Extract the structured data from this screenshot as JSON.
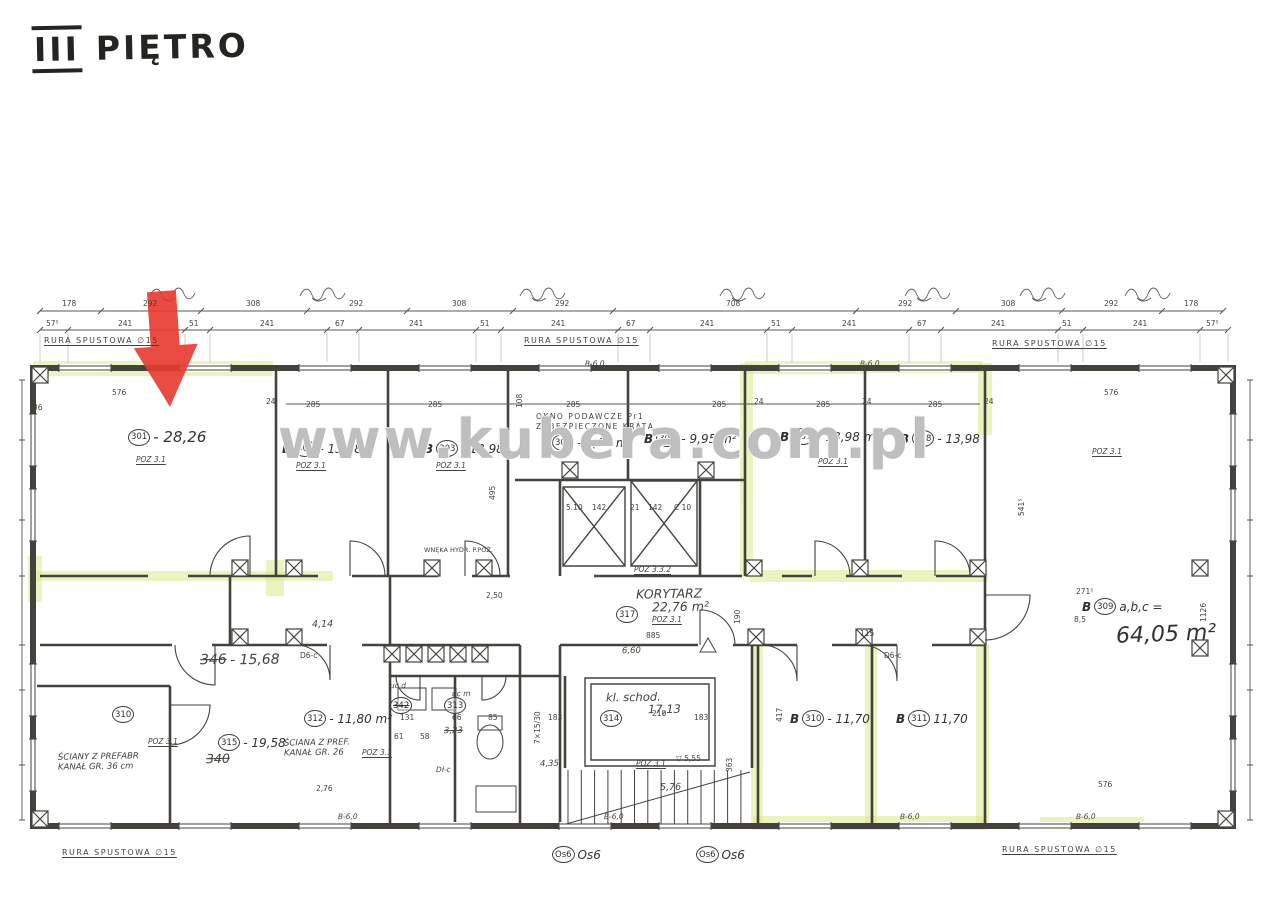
{
  "page": {
    "title_roman": "III",
    "title_text": "PIĘTRO"
  },
  "watermark": {
    "text": "www.kubera.com.pl",
    "color": "#8a8a8a"
  },
  "marker": {
    "description": "red arrow pointing at top wall of room 301",
    "color": "#e8392f"
  },
  "highlight_color": "#d7e783",
  "dims": {
    "row1": [
      "178",
      "292",
      "308",
      "292",
      "308",
      "292",
      "708",
      "292",
      "308",
      "292",
      "178"
    ],
    "row2": [
      "57⁵",
      "241",
      "51",
      "241",
      "67",
      "241",
      "51",
      "241",
      "67",
      "241",
      "51",
      "241",
      "67",
      "241",
      "51",
      "241",
      "57⁵"
    ]
  },
  "rooms": [
    {
      "pre": "",
      "num": "301",
      "post": "- 28,26",
      "x": 128,
      "y": 428,
      "big": true
    },
    {
      "pre": "B",
      "num": "302",
      "post": "- 13,98",
      "x": 282,
      "y": 440
    },
    {
      "pre": "B",
      "num": "303",
      "post": "- 13,98",
      "x": 424,
      "y": 440
    },
    {
      "pre": "",
      "num": "304",
      "post": "- 9,60 m²",
      "x": 552,
      "y": 434
    },
    {
      "pre": "B",
      "num": "306",
      "post": "- 9,95 m²",
      "x": 644,
      "y": 430
    },
    {
      "pre": "B",
      "num": "307",
      "post": "- 13,98 m²",
      "x": 780,
      "y": 428
    },
    {
      "pre": "B",
      "num": "308",
      "post": "- 13,98",
      "x": 900,
      "y": 430
    },
    {
      "pre": "B",
      "num": "309",
      "post": "a,b,c =",
      "x": 1082,
      "y": 598
    },
    {
      "pre": "",
      "num": "317",
      "post": "",
      "x": 616,
      "y": 606
    },
    {
      "pre": "",
      "num": "314",
      "post": "",
      "x": 600,
      "y": 710
    },
    {
      "pre": "",
      "num": "310",
      "post": "",
      "x": 112,
      "y": 706
    },
    {
      "pre": "",
      "num": "315",
      "post": "- 19,58",
      "x": 218,
      "y": 734
    },
    {
      "pre": "",
      "num": "313",
      "post": "",
      "x": 444,
      "y": 697
    },
    {
      "pre": "",
      "num": "342",
      "post": "",
      "x": 390,
      "y": 697,
      "struck": true
    },
    {
      "pre": "",
      "num": "312",
      "post": "- 11,80 m²",
      "x": 304,
      "y": 710
    },
    {
      "pre": "B",
      "num": "310",
      "post": "- 11,70",
      "x": 790,
      "y": 710
    },
    {
      "pre": "B",
      "num": "311",
      "post": "11,70",
      "x": 896,
      "y": 710
    },
    {
      "pre": "",
      "num": "Os6",
      "post": "Os6",
      "x": 552,
      "y": 846
    },
    {
      "pre": "",
      "num": "Os6",
      "post": "Os6",
      "x": 696,
      "y": 846
    }
  ],
  "labels": [
    {
      "t": "RURA SPUSTOWA ∅15",
      "x": 44,
      "y": 337,
      "c": "tech u"
    },
    {
      "t": "RURA SPUSTOWA ∅15",
      "x": 524,
      "y": 337,
      "c": "tech u"
    },
    {
      "t": "RURA SPUSTOWA ∅15",
      "x": 992,
      "y": 340,
      "c": "tech u"
    },
    {
      "t": "RURA SPUSTOWA ∅15",
      "x": 62,
      "y": 849,
      "c": "tech u"
    },
    {
      "t": "RURA SPUSTOWA ∅15",
      "x": 1002,
      "y": 846,
      "c": "tech u"
    },
    {
      "t": "OKNO PODAWCZE Pr1",
      "x": 536,
      "y": 413,
      "c": "tech s7"
    },
    {
      "t": "ZABEZPIECZONE KRATĄ",
      "x": 536,
      "y": 423,
      "c": "tech s7"
    },
    {
      "t": "WNĘKA HYDR. P.POŻ.",
      "x": 424,
      "y": 547,
      "c": "tech s6"
    },
    {
      "t": "ŚCIANY Z PREFABR",
      "x": 58,
      "y": 753,
      "c": "hand s8"
    },
    {
      "t": "KANAŁ GR. 36 cm",
      "x": 58,
      "y": 763,
      "c": "hand s8"
    },
    {
      "t": "ŚCIANA Z PREF.",
      "x": 284,
      "y": 739,
      "c": "hand s8"
    },
    {
      "t": "KANAŁ GR. 26",
      "x": 284,
      "y": 749,
      "c": "hand s8"
    },
    {
      "t": "POZ 3.1",
      "x": 136,
      "y": 456,
      "c": "pos"
    },
    {
      "t": "POZ 3.1",
      "x": 296,
      "y": 462,
      "c": "pos"
    },
    {
      "t": "POZ 3.1",
      "x": 436,
      "y": 462,
      "c": "pos"
    },
    {
      "t": "POZ 3.1",
      "x": 818,
      "y": 458,
      "c": "pos"
    },
    {
      "t": "POZ 3.1",
      "x": 1092,
      "y": 448,
      "c": "pos"
    },
    {
      "t": "POZ 3.1",
      "x": 652,
      "y": 616,
      "c": "pos"
    },
    {
      "t": "POZ 3.1",
      "x": 148,
      "y": 738,
      "c": "pos"
    },
    {
      "t": "POZ 3.1",
      "x": 362,
      "y": 749,
      "c": "pos"
    },
    {
      "t": "POZ 3.1",
      "x": 636,
      "y": 760,
      "c": "pos"
    },
    {
      "t": "POZ 3.3.2",
      "x": 634,
      "y": 566,
      "c": "pos"
    },
    {
      "t": "KORYTARZ",
      "x": 636,
      "y": 588,
      "c": "hand s12"
    },
    {
      "t": "22,76 m²",
      "x": 652,
      "y": 601,
      "c": "hand s12"
    },
    {
      "t": "kl. schod.",
      "x": 606,
      "y": 692,
      "c": "hand s11"
    },
    {
      "t": "17,13",
      "x": 648,
      "y": 704,
      "c": "hand s11"
    },
    {
      "t": "64,05 m²",
      "x": 1116,
      "y": 624,
      "c": "hand-big"
    },
    {
      "t": "346",
      "x": 200,
      "y": 653,
      "c": "hand s13 struck"
    },
    {
      "t": "- 15,68",
      "x": 230,
      "y": 653,
      "c": "hand s13"
    },
    {
      "t": "340",
      "x": 206,
      "y": 753,
      "c": "hand s12 struck"
    },
    {
      "t": "3,23",
      "x": 444,
      "y": 727,
      "c": "hand s8 struck"
    },
    {
      "t": "4,14",
      "x": 312,
      "y": 620,
      "c": "hand s9"
    },
    {
      "t": "4,35",
      "x": 540,
      "y": 760,
      "c": "hand s8"
    },
    {
      "t": "6,60",
      "x": 622,
      "y": 647,
      "c": "hand s8"
    },
    {
      "t": "5,76",
      "x": 660,
      "y": 783,
      "c": "hand s9"
    },
    {
      "t": "2,76",
      "x": 316,
      "y": 785,
      "c": "dim"
    },
    {
      "t": "B-6,0",
      "x": 338,
      "y": 813,
      "c": "hand s7"
    },
    {
      "t": "B-6,0",
      "x": 604,
      "y": 813,
      "c": "hand s7"
    },
    {
      "t": "B-6,0",
      "x": 900,
      "y": 813,
      "c": "hand s7"
    },
    {
      "t": "B-6,0",
      "x": 1076,
      "y": 813,
      "c": "hand s7"
    },
    {
      "t": "B-6,0",
      "x": 585,
      "y": 360,
      "c": "hand s7"
    },
    {
      "t": "B-6,0",
      "x": 860,
      "y": 360,
      "c": "hand s7"
    },
    {
      "t": "uc d",
      "x": 390,
      "y": 682,
      "c": "hand s7"
    },
    {
      "t": "uc m",
      "x": 452,
      "y": 690,
      "c": "hand s7"
    },
    {
      "t": "Dł-c",
      "x": 436,
      "y": 766,
      "c": "hand s7"
    },
    {
      "t": "D6-c",
      "x": 300,
      "y": 652,
      "c": "dim s6"
    },
    {
      "t": "D6-c",
      "x": 884,
      "y": 652,
      "c": "dim s6"
    },
    {
      "t": "▽ 5,55",
      "x": 676,
      "y": 755,
      "c": "dim"
    },
    {
      "t": "576",
      "x": 112,
      "y": 389,
      "c": "dim"
    },
    {
      "t": "576",
      "x": 1104,
      "y": 389,
      "c": "dim"
    },
    {
      "t": "576",
      "x": 1098,
      "y": 781,
      "c": "dim"
    },
    {
      "t": "285",
      "x": 306,
      "y": 401,
      "c": "dim"
    },
    {
      "t": "285",
      "x": 428,
      "y": 401,
      "c": "dim"
    },
    {
      "t": "285",
      "x": 566,
      "y": 401,
      "c": "dim"
    },
    {
      "t": "285",
      "x": 712,
      "y": 401,
      "c": "dim"
    },
    {
      "t": "285",
      "x": 816,
      "y": 401,
      "c": "dim"
    },
    {
      "t": "285",
      "x": 928,
      "y": 401,
      "c": "dim"
    },
    {
      "t": "24",
      "x": 266,
      "y": 398,
      "c": "dim s6"
    },
    {
      "t": "24",
      "x": 754,
      "y": 398,
      "c": "dim s6"
    },
    {
      "t": "24",
      "x": 862,
      "y": 398,
      "c": "dim s6"
    },
    {
      "t": "24",
      "x": 984,
      "y": 398,
      "c": "dim s6"
    },
    {
      "t": "36",
      "x": 33,
      "y": 404,
      "c": "dim s6"
    },
    {
      "t": "885",
      "x": 646,
      "y": 632,
      "c": "dim"
    },
    {
      "t": "210",
      "x": 652,
      "y": 710,
      "c": "dim"
    },
    {
      "t": "183",
      "x": 694,
      "y": 714,
      "c": "dim"
    },
    {
      "t": "183",
      "x": 548,
      "y": 714,
      "c": "dim"
    },
    {
      "t": "131",
      "x": 400,
      "y": 714,
      "c": "dim s6"
    },
    {
      "t": "61",
      "x": 394,
      "y": 733,
      "c": "dim s6"
    },
    {
      "t": "58",
      "x": 420,
      "y": 733,
      "c": "dim s6"
    },
    {
      "t": "66",
      "x": 452,
      "y": 714,
      "c": "dim s6"
    },
    {
      "t": "85",
      "x": 488,
      "y": 714,
      "c": "dim s6"
    },
    {
      "t": "115",
      "x": 860,
      "y": 630,
      "c": "dim s6"
    },
    {
      "t": "2,50",
      "x": 486,
      "y": 592,
      "c": "dim"
    },
    {
      "t": "271⁵",
      "x": 1076,
      "y": 588,
      "c": "dim"
    },
    {
      "t": "8,5",
      "x": 1074,
      "y": 616,
      "c": "dim s6"
    },
    {
      "t": "5.10",
      "x": 566,
      "y": 504,
      "c": "dim s6"
    },
    {
      "t": "142",
      "x": 592,
      "y": 504,
      "c": "dim s6"
    },
    {
      "t": "21",
      "x": 630,
      "y": 504,
      "c": "dim s6"
    },
    {
      "t": "142",
      "x": 648,
      "y": 504,
      "c": "dim s6"
    },
    {
      "t": "C 10",
      "x": 674,
      "y": 504,
      "c": "dim s6"
    },
    {
      "t": "417",
      "x": 776,
      "y": 722,
      "c": "dim",
      "r": -90
    },
    {
      "t": "1126",
      "x": 1200,
      "y": 622,
      "c": "dim",
      "r": -90
    },
    {
      "t": "363",
      "x": 726,
      "y": 772,
      "c": "dim",
      "r": -90
    },
    {
      "t": "190",
      "x": 734,
      "y": 624,
      "c": "dim s6",
      "r": -90
    },
    {
      "t": "108",
      "x": 516,
      "y": 408,
      "c": "dim s6",
      "r": -90
    },
    {
      "t": "541⁵",
      "x": 1018,
      "y": 516,
      "c": "dim s6",
      "r": -90
    },
    {
      "t": "495",
      "x": 489,
      "y": 500,
      "c": "dim s6",
      "r": -90
    },
    {
      "t": "7×15/30",
      "x": 534,
      "y": 744,
      "c": "dim s6",
      "r": -90
    }
  ]
}
